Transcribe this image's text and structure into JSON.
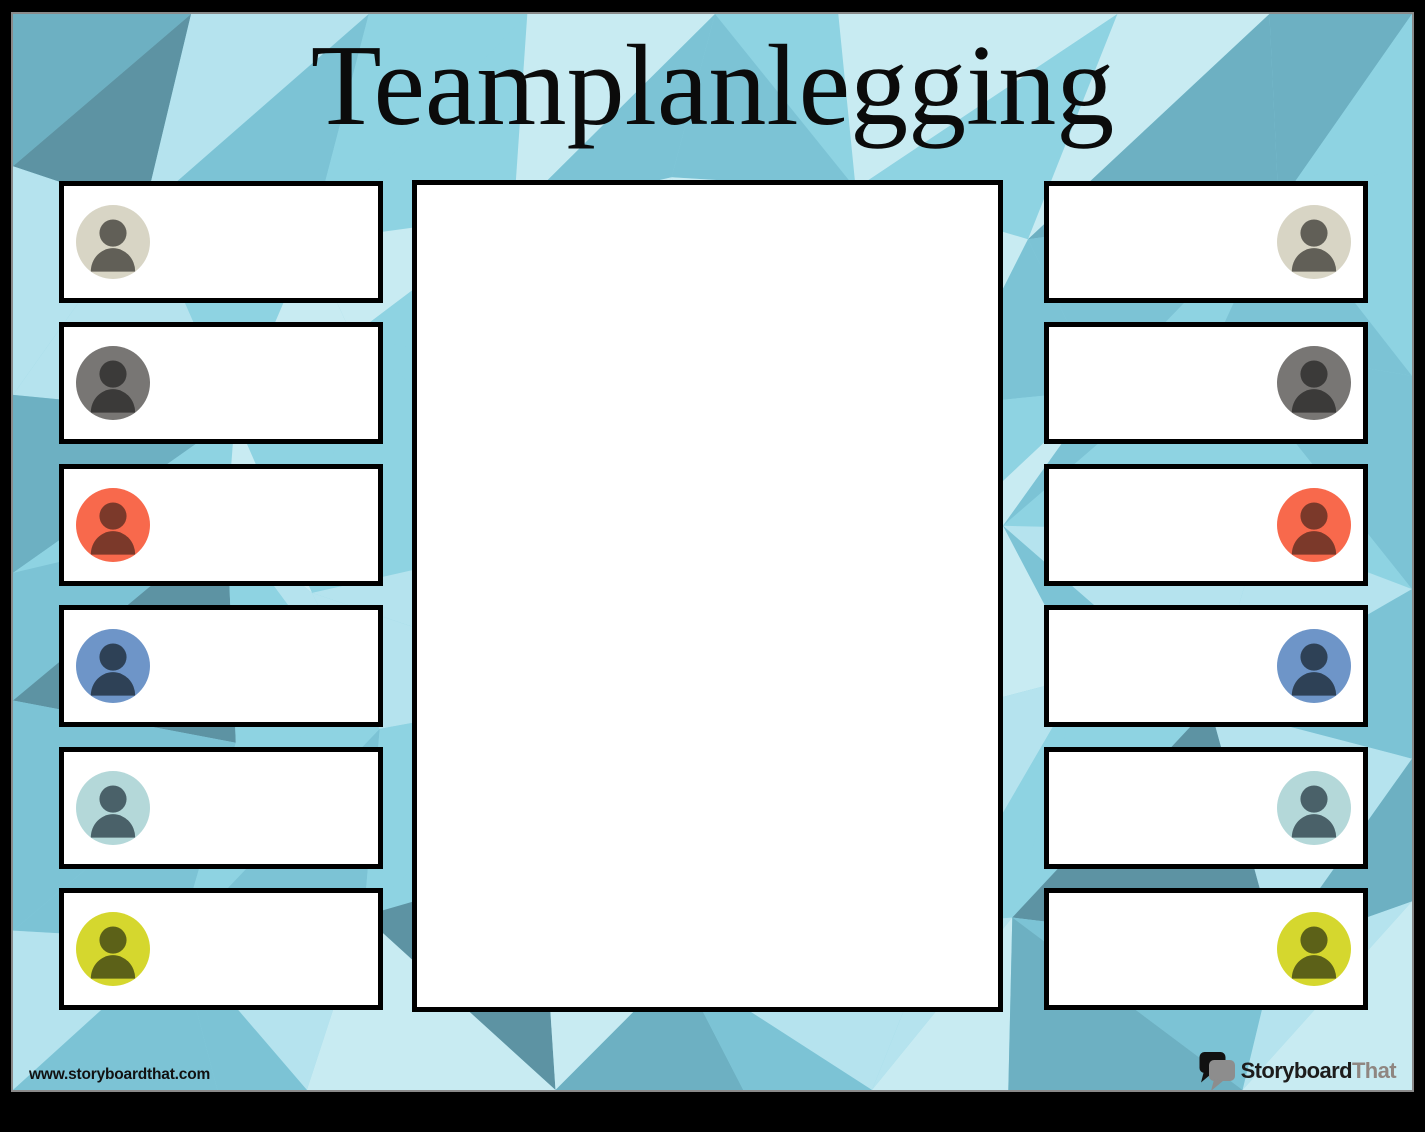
{
  "title": "Teamplanlegging",
  "background": {
    "palette": [
      "#8ed3e2",
      "#7cc3d5",
      "#6db0c2",
      "#5d93a3",
      "#b5e3ee",
      "#c8ebf2"
    ],
    "frame_color": "#000000",
    "edge_line_color": "#8a8a8a"
  },
  "center_panel": {
    "fill": "#ffffff",
    "border_color": "#000000"
  },
  "team_members": {
    "left": [
      {
        "icon": "person-icon",
        "avatar_bg": "#d8d5c5",
        "avatar_fg": "#615f57"
      },
      {
        "icon": "person-icon",
        "avatar_bg": "#787674",
        "avatar_fg": "#3b3a39"
      },
      {
        "icon": "person-icon",
        "avatar_bg": "#f8694c",
        "avatar_fg": "#7b392a"
      },
      {
        "icon": "person-icon",
        "avatar_bg": "#6e95c8",
        "avatar_fg": "#2e4156"
      },
      {
        "icon": "person-icon",
        "avatar_bg": "#b4d8d9",
        "avatar_fg": "#4a6169"
      },
      {
        "icon": "person-icon",
        "avatar_bg": "#d5d72e",
        "avatar_fg": "#5c6118"
      }
    ],
    "right": [
      {
        "icon": "person-icon",
        "avatar_bg": "#d8d5c5",
        "avatar_fg": "#615f57"
      },
      {
        "icon": "person-icon",
        "avatar_bg": "#787674",
        "avatar_fg": "#3b3a39"
      },
      {
        "icon": "person-icon",
        "avatar_bg": "#f8694c",
        "avatar_fg": "#7b392a"
      },
      {
        "icon": "person-icon",
        "avatar_bg": "#6e95c8",
        "avatar_fg": "#2e4156"
      },
      {
        "icon": "person-icon",
        "avatar_bg": "#b4d8d9",
        "avatar_fg": "#4a6169"
      },
      {
        "icon": "person-icon",
        "avatar_bg": "#d5d72e",
        "avatar_fg": "#5c6118"
      }
    ]
  },
  "footer": {
    "website": "www.storyboardthat.com",
    "logo": {
      "icon": "speech-bubbles-icon",
      "text_primary": "Storyboard",
      "text_secondary": "That",
      "primary_color": "#1d1c1c",
      "secondary_color": "#8f8681",
      "bubble_back_color": "#111111",
      "bubble_front_color": "#8d8d8d"
    }
  }
}
